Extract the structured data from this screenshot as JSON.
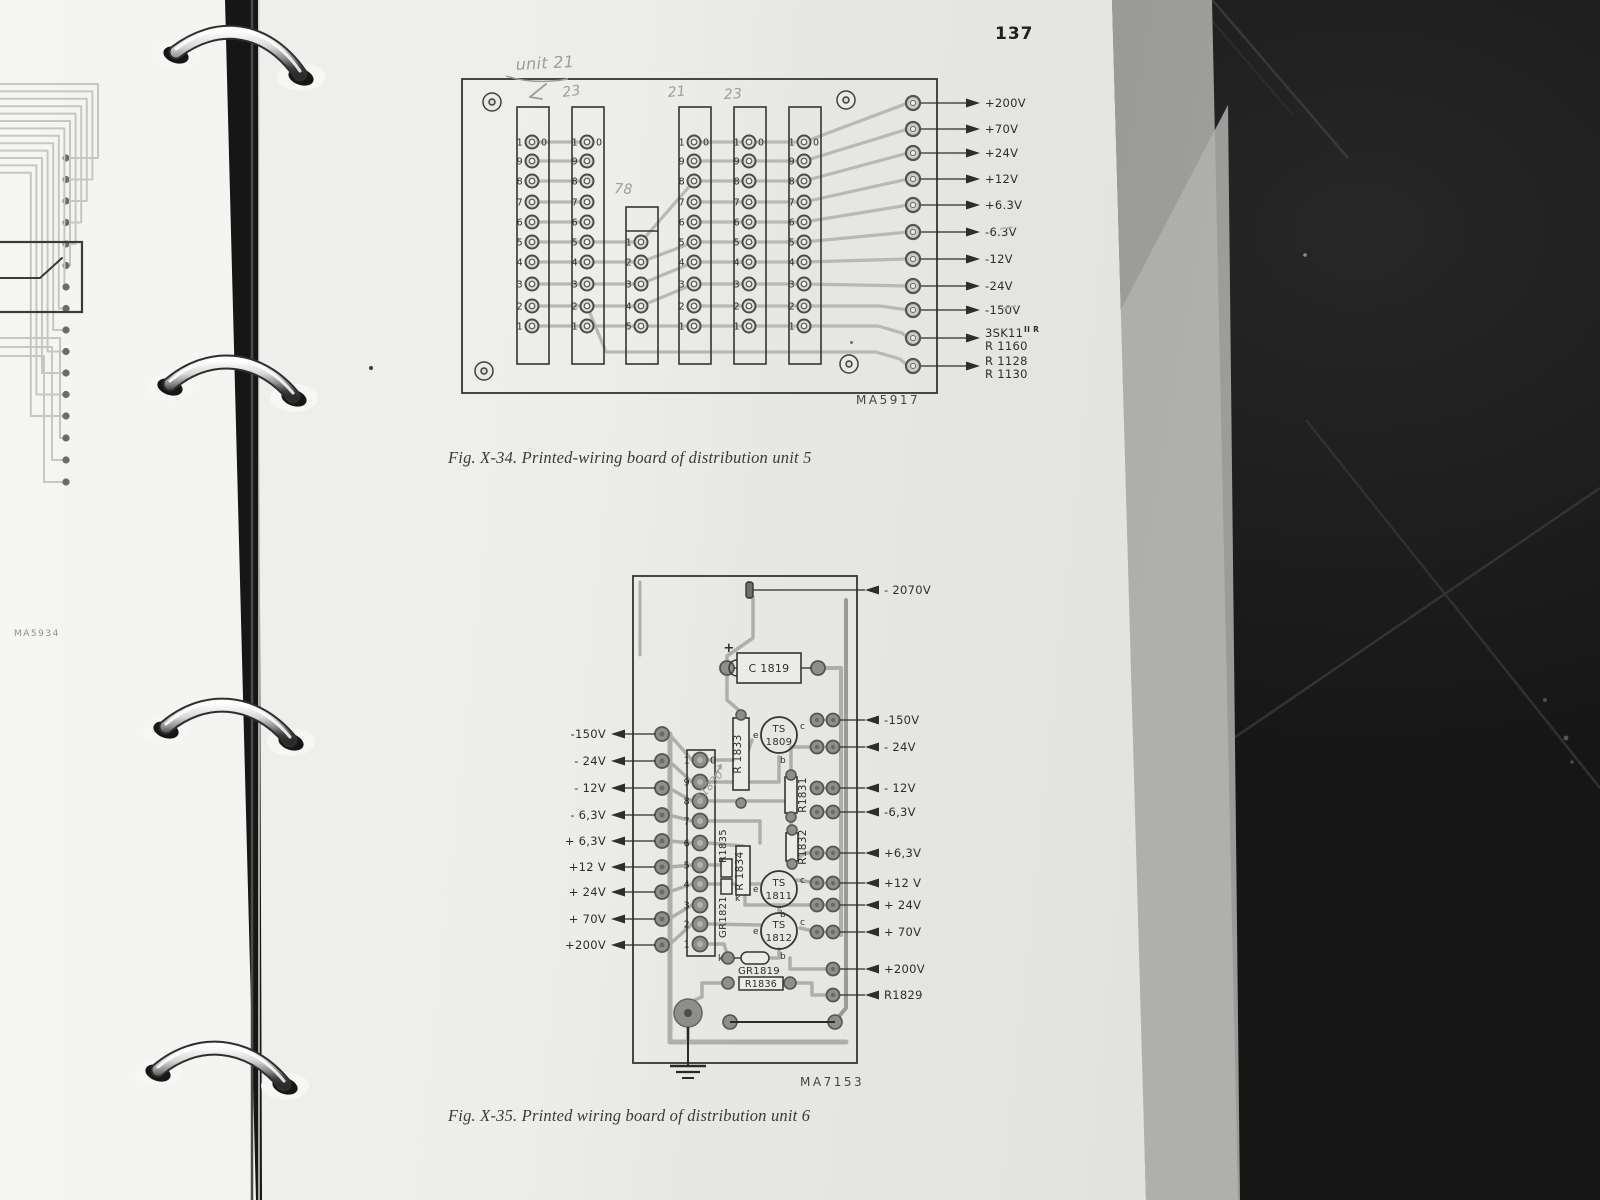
{
  "page_number": "137",
  "left_page": {
    "board_code": "MA5934"
  },
  "fig34": {
    "board_code": "MA5917",
    "caption": "Fig. X-34. Printed-wiring board of distribution unit 5",
    "connector_pin_labels": [
      "10",
      "9",
      "8",
      "7",
      "6",
      "5",
      "4",
      "3",
      "2",
      "1"
    ],
    "small_connector_pin_labels": [
      "1",
      "2",
      "3",
      "4",
      "5"
    ],
    "outputs": [
      {
        "lines": [
          "+200V"
        ]
      },
      {
        "lines": [
          "+70V"
        ]
      },
      {
        "lines": [
          "+24V"
        ]
      },
      {
        "lines": [
          "+12V"
        ]
      },
      {
        "lines": [
          "+6.3V"
        ]
      },
      {
        "lines": [
          "-6.3V"
        ]
      },
      {
        "lines": [
          "-12V"
        ]
      },
      {
        "lines": [
          "-24V"
        ]
      },
      {
        "lines": [
          "-150V"
        ]
      },
      {
        "lines": [
          "3SK11",
          "R 1160"
        ],
        "superscript": "II R"
      },
      {
        "lines": [
          "R 1128",
          "R 1130"
        ]
      }
    ],
    "handwritten": {
      "title": "unit 21",
      "c2": "23",
      "c4": "21",
      "c5": "23",
      "c3": "78"
    }
  },
  "fig35": {
    "board_code": "MA7153",
    "caption": "Fig. X-35. Printed wiring board of distribution unit 6",
    "top_output": "- 2070V",
    "left_outputs": [
      "-150V",
      "- 24V",
      "- 12V",
      "- 6,3V",
      "+ 6,3V",
      "+12 V",
      "+ 24V",
      "+ 70V",
      "+200V"
    ],
    "right_outputs": [
      "-150V",
      "- 24V",
      "- 12V",
      "-6,3V",
      "+6,3V",
      "+12 V",
      "+ 24V",
      "+ 70V",
      "+200V",
      "R1829"
    ],
    "connector_pin_labels": [
      "10",
      "9",
      "8",
      "7",
      "6",
      "5",
      "4",
      "3",
      "2",
      "1"
    ],
    "components": {
      "capacitor": "C 1819",
      "transistor1": [
        "TS",
        "1809"
      ],
      "transistor2": [
        "TS",
        "1811"
      ],
      "transistor3": [
        "TS",
        "1812"
      ],
      "r1833": "R 1833",
      "r1834": "R 1834",
      "r1835": "R1835",
      "r1831": "R1831",
      "r1832": "R1832",
      "r1836": "R1836",
      "gr1821": "GR1821",
      "gr1819": "GR1819"
    },
    "marks": {
      "plus": "+",
      "cathode": "k",
      "emitter": "e",
      "base": "b",
      "collector": "c"
    },
    "handwritten": "R1830"
  },
  "colors": {
    "paper": "#ededeb",
    "print_dark": "#2d2d2b",
    "trace_light": "#b8b8b6",
    "trace_mid": "#aeaeac",
    "pencil": "#9c9c9a",
    "background_dark": "#1b1b1b"
  }
}
